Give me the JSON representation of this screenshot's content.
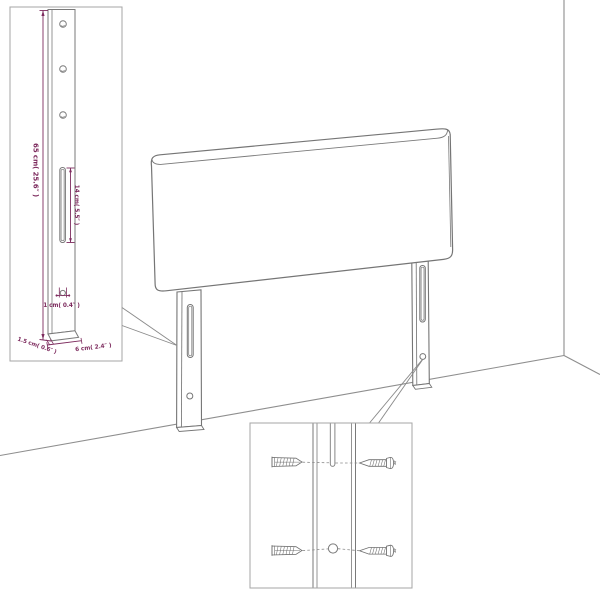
{
  "diagram": {
    "name": "headboard-wall-mounting-diagram",
    "background": "#ffffff",
    "colors": {
      "outline": "#757575",
      "room_line": "#8e8e8e",
      "inset_border": "#a5a5a5",
      "dimension": "#7d2b5e"
    },
    "leg_detail": {
      "height_label": "65 cm( 25.6″ )",
      "slot_label": "14 cm( 5.5″ )",
      "hole_label": "1 cm( 0.4″ )",
      "depth_label": "1.5 cm( 0.6″ )",
      "width_label": "6 cm( 2.4″ )"
    },
    "mounting_detail": {
      "wall_plug_icon": "wall-plug",
      "screw_icon": "screw",
      "wall_plug_count": 2,
      "screw_count": 2
    }
  }
}
